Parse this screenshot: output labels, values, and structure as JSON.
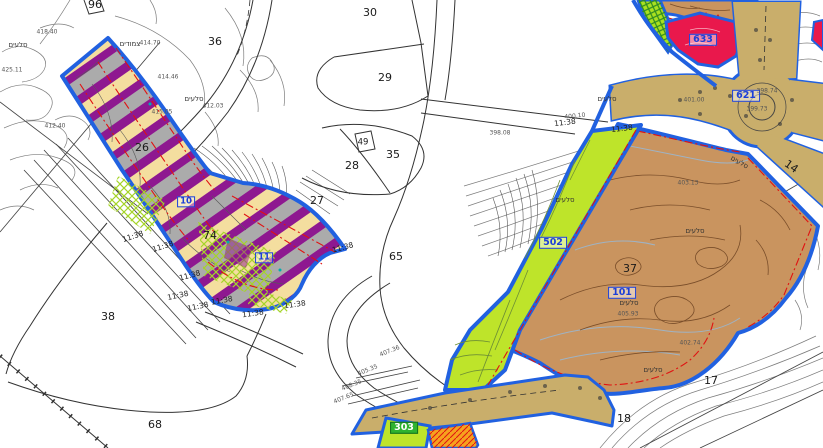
{
  "map": {
    "colors": {
      "plan_boundary_blue": "#2161E0",
      "stripe_purple": "#8E1890",
      "stripe_yellow": "#F4DE9F",
      "stripe_gray": "#ABABAB",
      "open_space_lime": "#BEE42A",
      "nature_brown": "#C9945F",
      "road_tan": "#C9AE6B",
      "public_red": "#E9184C",
      "orange_lot": "#F6A21E",
      "red_dashdot_line": "#E01212",
      "label_blue": "#1C3FD8"
    },
    "labels": [
      {
        "text": "96",
        "x": 95,
        "y": 5,
        "kind": "parcel",
        "name": "parcel-96"
      },
      {
        "text": "36",
        "x": 215,
        "y": 42,
        "kind": "parcel",
        "name": "parcel-36"
      },
      {
        "text": "30",
        "x": 370,
        "y": 13,
        "kind": "parcel",
        "name": "parcel-30"
      },
      {
        "text": "29",
        "x": 385,
        "y": 78,
        "kind": "parcel",
        "name": "parcel-29"
      },
      {
        "text": "35",
        "x": 393,
        "y": 155,
        "kind": "parcel",
        "name": "parcel-35"
      },
      {
        "text": "28",
        "x": 352,
        "y": 166,
        "kind": "parcel",
        "name": "parcel-28"
      },
      {
        "text": "27",
        "x": 317,
        "y": 201,
        "kind": "parcel",
        "name": "parcel-27"
      },
      {
        "text": "49",
        "x": 363,
        "y": 143,
        "kind": "parcel-sm",
        "name": "parcel-49"
      },
      {
        "text": "65",
        "x": 396,
        "y": 257,
        "kind": "parcel",
        "name": "parcel-65"
      },
      {
        "text": "26",
        "x": 142,
        "y": 148,
        "kind": "parcel",
        "name": "parcel-26"
      },
      {
        "text": "74",
        "x": 210,
        "y": 236,
        "kind": "parcel",
        "name": "parcel-74"
      },
      {
        "text": "38",
        "x": 108,
        "y": 317,
        "kind": "parcel",
        "name": "parcel-38"
      },
      {
        "text": "68",
        "x": 155,
        "y": 425,
        "kind": "parcel",
        "name": "parcel-68"
      },
      {
        "text": "37",
        "x": 630,
        "y": 269,
        "kind": "parcel",
        "name": "parcel-37"
      },
      {
        "text": "17",
        "x": 711,
        "y": 381,
        "kind": "parcel",
        "name": "parcel-17"
      },
      {
        "text": "18",
        "x": 624,
        "y": 419,
        "kind": "parcel",
        "name": "parcel-18"
      },
      {
        "text": "14",
        "x": 791,
        "y": 167,
        "kind": "parcel",
        "rot": 35,
        "name": "parcel-14"
      },
      {
        "text": "10",
        "x": 186,
        "y": 202,
        "kind": "zbox-sm",
        "name": "lot-box-10"
      },
      {
        "text": "11",
        "x": 264,
        "y": 258,
        "kind": "zbox-sm",
        "name": "lot-box-11"
      },
      {
        "text": "502",
        "x": 553,
        "y": 243,
        "kind": "zbox",
        "name": "zone-box-502"
      },
      {
        "text": "101",
        "x": 622,
        "y": 293,
        "kind": "zbox",
        "name": "zone-box-101"
      },
      {
        "text": "621",
        "x": 746,
        "y": 96,
        "kind": "zbox",
        "name": "zone-box-621"
      },
      {
        "text": "633",
        "x": 703,
        "y": 40,
        "kind": "zbox",
        "name": "zone-box-633"
      },
      {
        "text": "303",
        "x": 404,
        "y": 428,
        "kind": "zbox-green",
        "name": "zone-box-303"
      },
      {
        "text": "11:38",
        "x": 133,
        "y": 237,
        "kind": "roadnum",
        "rot": -18
      },
      {
        "text": "11:38",
        "x": 163,
        "y": 247,
        "kind": "roadnum",
        "rot": -18
      },
      {
        "text": "11:38",
        "x": 190,
        "y": 276,
        "kind": "roadnum",
        "rot": -15
      },
      {
        "text": "11:38",
        "x": 178,
        "y": 296,
        "kind": "roadnum",
        "rot": -12
      },
      {
        "text": "11:38",
        "x": 198,
        "y": 307,
        "kind": "roadnum",
        "rot": -12
      },
      {
        "text": "11:38",
        "x": 222,
        "y": 301,
        "kind": "roadnum",
        "rot": -10
      },
      {
        "text": "11:38",
        "x": 253,
        "y": 314,
        "kind": "roadnum",
        "rot": -8
      },
      {
        "text": "11:38",
        "x": 295,
        "y": 305,
        "kind": "roadnum",
        "rot": -8
      },
      {
        "text": "11:38",
        "x": 343,
        "y": 248,
        "kind": "roadnum",
        "rot": -15
      },
      {
        "text": "11:38",
        "x": 565,
        "y": 123,
        "kind": "roadnum",
        "rot": -7
      },
      {
        "text": "11:38",
        "x": 622,
        "y": 129,
        "kind": "roadnum",
        "rot": -7
      },
      {
        "text": "סלעים",
        "x": 18,
        "y": 46,
        "kind": "heb"
      },
      {
        "text": "סלעים",
        "x": 194,
        "y": 100,
        "kind": "heb"
      },
      {
        "text": "צמודים",
        "x": 130,
        "y": 45,
        "kind": "heb"
      },
      {
        "text": "סלעים",
        "x": 607,
        "y": 100,
        "kind": "heb"
      },
      {
        "text": "סלעים",
        "x": 565,
        "y": 201,
        "kind": "heb"
      },
      {
        "text": "סלעים",
        "x": 695,
        "y": 232,
        "kind": "heb"
      },
      {
        "text": "סלעים",
        "x": 629,
        "y": 304,
        "kind": "heb"
      },
      {
        "text": "סלעים",
        "x": 653,
        "y": 371,
        "kind": "heb"
      },
      {
        "text": "סלעים",
        "x": 739,
        "y": 163,
        "kind": "heb",
        "rot": 30
      },
      {
        "text": "418.40",
        "x": 47,
        "y": 33,
        "kind": "elev"
      },
      {
        "text": "425.11",
        "x": 12,
        "y": 71,
        "kind": "elev"
      },
      {
        "text": "414.70",
        "x": 150,
        "y": 44,
        "kind": "elev"
      },
      {
        "text": "414.46",
        "x": 168,
        "y": 78,
        "kind": "elev"
      },
      {
        "text": "412.03",
        "x": 213,
        "y": 107,
        "kind": "elev"
      },
      {
        "text": "415.05",
        "x": 162,
        "y": 113,
        "kind": "elev"
      },
      {
        "text": "412.40",
        "x": 55,
        "y": 127,
        "kind": "elev"
      },
      {
        "text": "398.08",
        "x": 500,
        "y": 134,
        "kind": "elev"
      },
      {
        "text": "400.10",
        "x": 575,
        "y": 117,
        "kind": "elev",
        "rot": -6
      },
      {
        "text": "401.00",
        "x": 694,
        "y": 101,
        "kind": "elev"
      },
      {
        "text": "399.73",
        "x": 757,
        "y": 110,
        "kind": "elev"
      },
      {
        "text": "398.74",
        "x": 767,
        "y": 92,
        "kind": "elev"
      },
      {
        "text": "405.93",
        "x": 628,
        "y": 315,
        "kind": "elev"
      },
      {
        "text": "402.74",
        "x": 690,
        "y": 344,
        "kind": "elev"
      },
      {
        "text": "403.13",
        "x": 688,
        "y": 184,
        "kind": "elev"
      },
      {
        "text": "407.36",
        "x": 390,
        "y": 352,
        "kind": "elev",
        "rot": -22
      },
      {
        "text": "405.35",
        "x": 368,
        "y": 371,
        "kind": "elev",
        "rot": -22
      },
      {
        "text": "408.35",
        "x": 352,
        "y": 386,
        "kind": "elev",
        "rot": -22
      },
      {
        "text": "407.65",
        "x": 344,
        "y": 399,
        "kind": "elev",
        "rot": -22
      }
    ]
  }
}
